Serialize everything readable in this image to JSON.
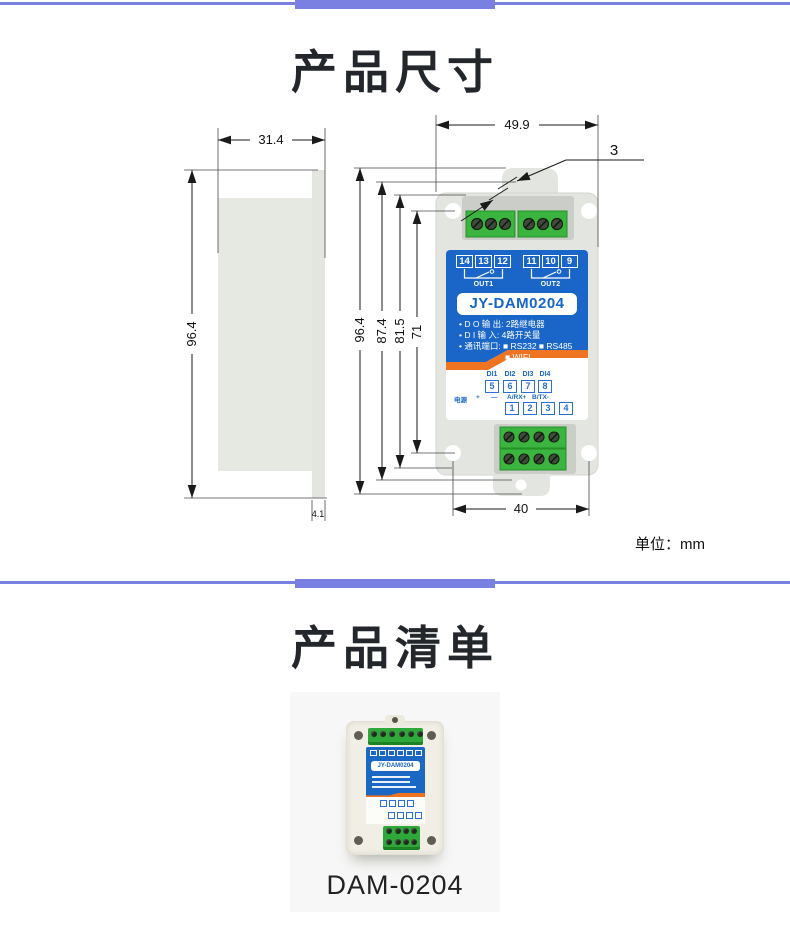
{
  "accent_color": "#7a80e2",
  "dimensions_section": {
    "title": "产品尺寸",
    "unit_note": "单位：mm",
    "side_view": {
      "width_mm": "31.4",
      "height_mm": "96.4",
      "plate_mm": "4.1"
    },
    "front_view": {
      "width_mm": "49.9",
      "clip_mm": "3",
      "height_mm": "96.4",
      "h2_mm": "87.4",
      "h3_mm": "81.5",
      "hole_span_v_mm": "71",
      "hole_span_h_mm": "40"
    }
  },
  "device_panel": {
    "model": "JY-DAM0204",
    "relay_group1": [
      "14",
      "13",
      "12"
    ],
    "relay_group2": [
      "11",
      "10",
      "9"
    ],
    "out1_label": "OUT1",
    "out2_label": "OUT2",
    "spec_lines": [
      "• D O 输 出: 2路继电器",
      "• D I 输 入: 4路开关量",
      "• 通讯端口: ■ RS232 ■ RS485",
      "■ WIFI"
    ],
    "di_labels": [
      "DI1",
      "DI2",
      "DI3",
      "DI4"
    ],
    "di_terminals": [
      "5",
      "6",
      "7",
      "8"
    ],
    "power_labels": [
      "电源",
      "+",
      "—",
      "A/RX+",
      "B/TX-"
    ],
    "bus_terminals": [
      "1",
      "2",
      "3",
      "4"
    ]
  },
  "product_list_section": {
    "title": "产品清单",
    "product_name": "DAM-0204",
    "product_photo_label": "JY-DAM0204"
  }
}
